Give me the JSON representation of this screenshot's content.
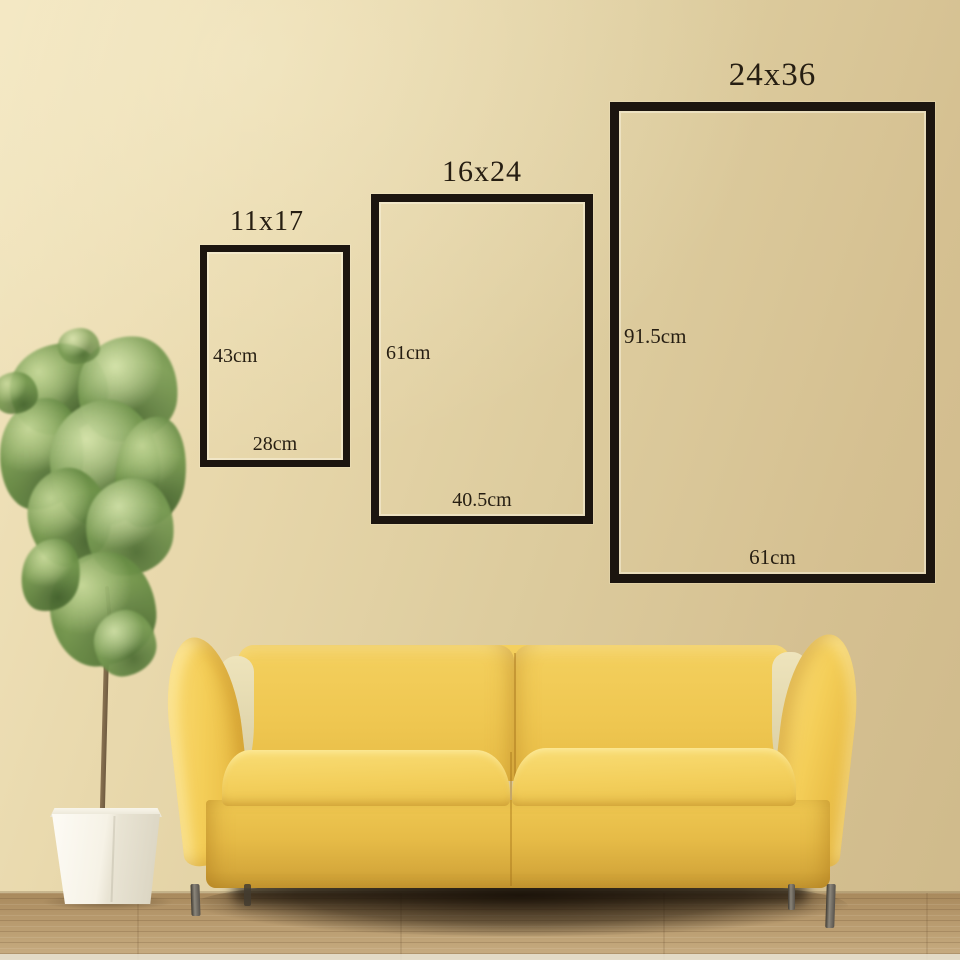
{
  "size_guide": {
    "frames": [
      {
        "title": "11x17",
        "height_label": "43cm",
        "width_label": "28cm"
      },
      {
        "title": "16x24",
        "height_label": "61cm",
        "width_label": "40.5cm"
      },
      {
        "title": "24x36",
        "height_label": "91.5cm",
        "width_label": "61cm"
      }
    ]
  },
  "colors": {
    "wall_beige": "#e2d1a4",
    "frame_outline_black": "#1c150f",
    "dimension_text": "#261e12",
    "sofa_yellow": "#efc94f",
    "floor_wood_brown": "#b2935f",
    "planter_white": "#f6f3ea",
    "plant_green": "#7ba04f"
  }
}
